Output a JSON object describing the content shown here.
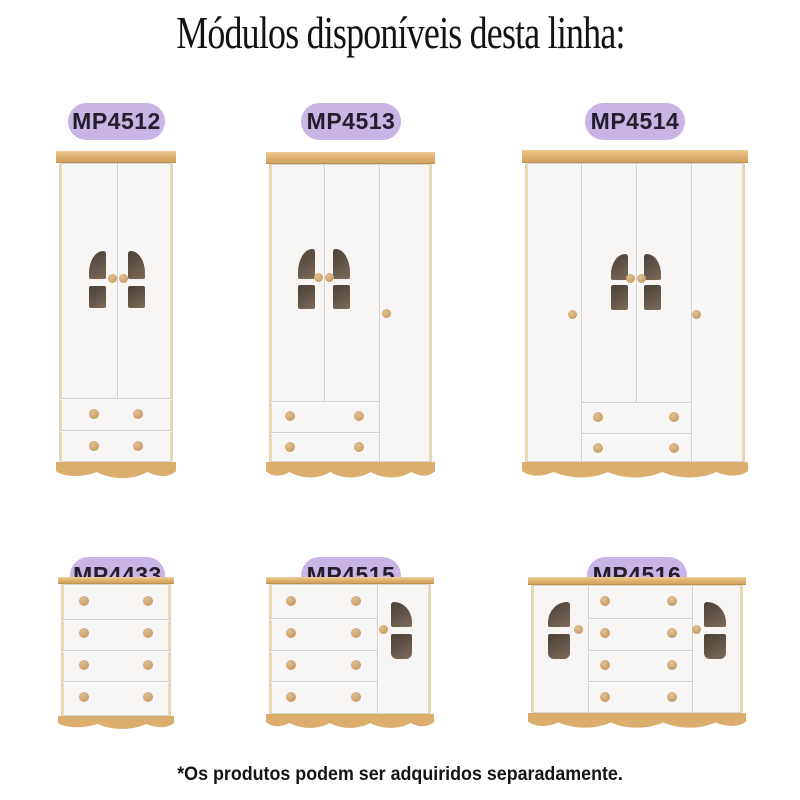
{
  "title": "Módulos disponíveis desta linha:",
  "footnote": "*Os produtos podem ser adquiridos separadamente.",
  "modules": [
    {
      "code": "MP4512",
      "kind": "wardrobe-2-doors-2-drawers"
    },
    {
      "code": "MP4513",
      "kind": "wardrobe-3-doors-2-drawers"
    },
    {
      "code": "MP4514",
      "kind": "wardrobe-4-doors-2-drawers"
    },
    {
      "code": "MP4433",
      "kind": "chest-4-drawers"
    },
    {
      "code": "MP4515",
      "kind": "dresser-4-drawers-1-door"
    },
    {
      "code": "MP4516",
      "kind": "dresser-4-drawers-2-doors"
    }
  ],
  "colors": {
    "badge_bg": "#c9b4e6",
    "badge_text": "#221e2b",
    "wood": "#dcae6e",
    "cabinet_white": "#f7f6f5",
    "window_dark": "#5d5044",
    "knob": "#cda673",
    "text": "#141414"
  }
}
